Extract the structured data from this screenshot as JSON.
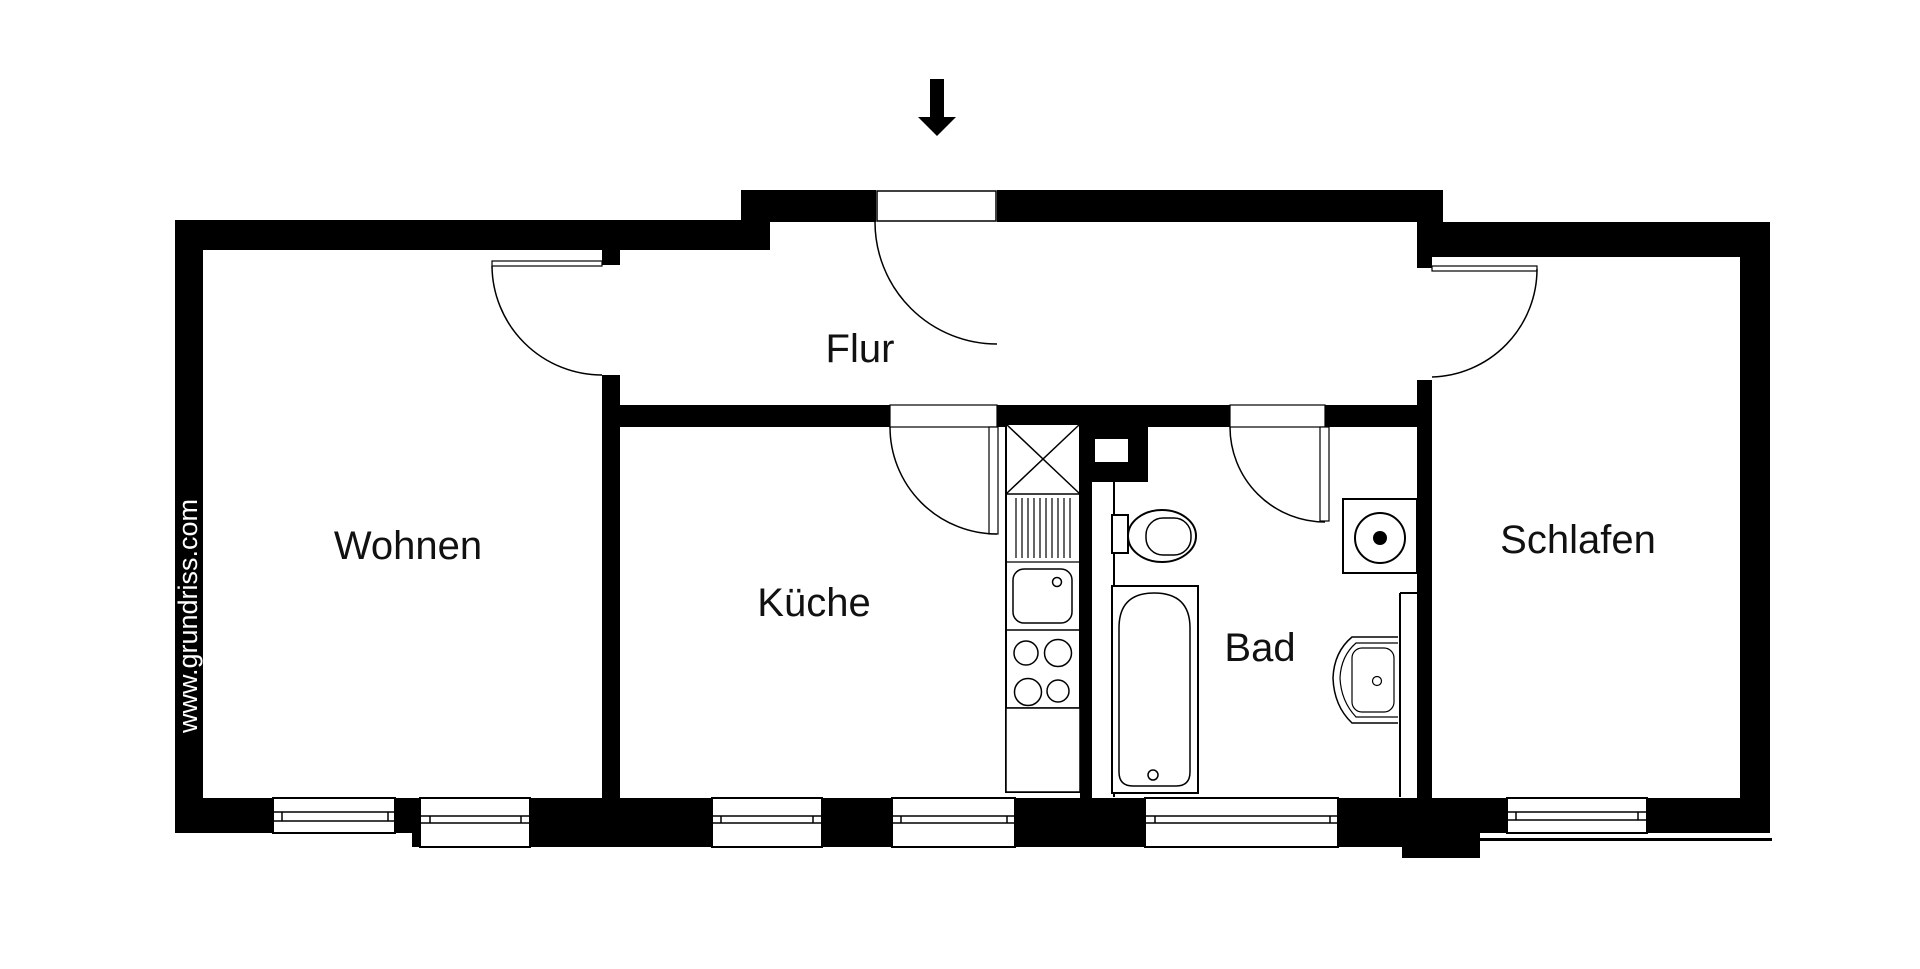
{
  "meta": {
    "type": "floor-plan",
    "canvas_width_px": 1920,
    "canvas_height_px": 969
  },
  "colors": {
    "wall": "#000000",
    "background": "#ffffff",
    "label_text": "#111111",
    "watermark_text": "#ffffff"
  },
  "watermark": {
    "text": "www.grundriss.com"
  },
  "entrance": {
    "icon": "entrance-arrow-icon",
    "direction": "down"
  },
  "rooms": [
    {
      "id": "flur",
      "label": "Flur"
    },
    {
      "id": "wohnen",
      "label": "Wohnen"
    },
    {
      "id": "kueche",
      "label": "Küche"
    },
    {
      "id": "bad",
      "label": "Bad"
    },
    {
      "id": "schlafen",
      "label": "Schlafen"
    }
  ],
  "fixtures": [
    "flue-cross-box",
    "dish-drainer",
    "kitchen-sink",
    "stove-4-burners",
    "kitchen-cabinet",
    "toilet",
    "bathtub",
    "washbasin",
    "washing-machine"
  ],
  "openings": {
    "doors": [
      "entrance-door",
      "wohnen-door",
      "kueche-door",
      "bad-door",
      "schlafen-door"
    ],
    "windows_count": 6
  }
}
